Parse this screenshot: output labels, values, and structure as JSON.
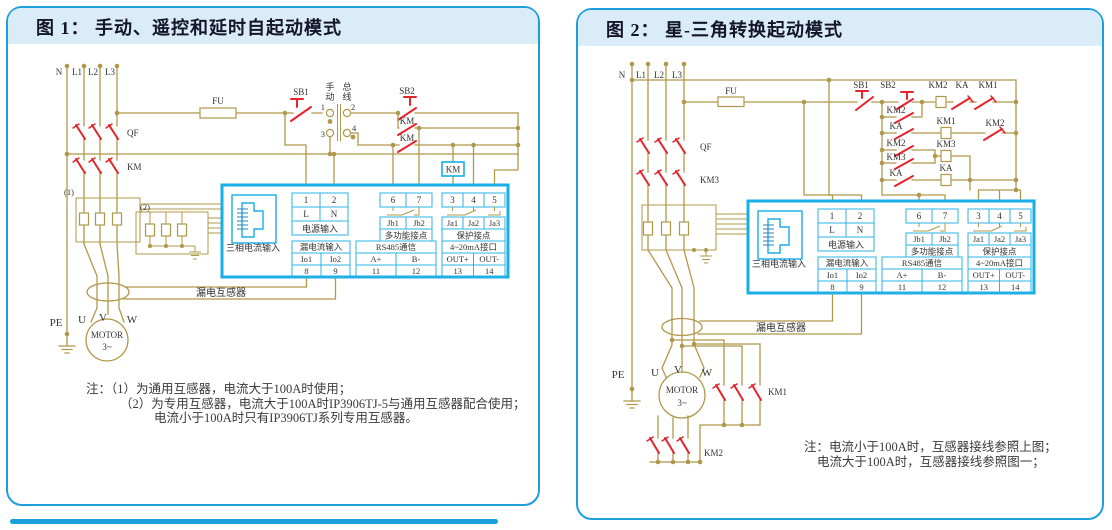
{
  "figure1": {
    "title": "图 1： 手动、遥控和延时自起动模式",
    "feeders": {
      "n": "N",
      "l1": "L1",
      "l2": "L2",
      "l3": "L3"
    },
    "labels": {
      "fu": "FU",
      "qf": "QF",
      "km_main": "KM",
      "sb1": "SB1",
      "sb2": "SB2",
      "manual_top": "手",
      "manual_bottom": "动",
      "bus_top": "总",
      "bus_bottom": "线",
      "sel1": "1",
      "sel2": "2",
      "sel3": "3",
      "sel4": "4",
      "km_aux1": "KM",
      "km_aux2": "KM",
      "km_coil": "KM",
      "ct1": "(1)",
      "ct2": "(2)",
      "pe": "PE",
      "u": "U",
      "v": "V",
      "w": "W",
      "motor": "MOTOR",
      "motor_sub": "3~",
      "leakage_ct": "漏电互感器"
    },
    "notes": [
      "注：（1）为通用互感器，电流大于100A时使用；",
      "（2）为专用互感器，电流大于100A时IP3906TJ-5与通用互感器配合使用；",
      "电流小于100A时只有IP3906TJ系列专用互感器。"
    ]
  },
  "figure2": {
    "title": "图 2： 星-三角转换起动模式",
    "feeders": {
      "n": "N",
      "l1": "L1",
      "l2": "L2",
      "l3": "L3"
    },
    "labels": {
      "fu": "FU",
      "qf": "QF",
      "km3_main": "KM3",
      "sb1": "SB1",
      "sb2": "SB2",
      "top_km2_coil": "KM2",
      "top_ka": "KA",
      "top_km1": "KM1",
      "r2_km2": "KM2",
      "r3_ka": "KA",
      "r3_km1_coil": "KM1",
      "r3_km2": "KM2",
      "r4_km2": "KM2",
      "r4_km3_coil": "KM3",
      "r5_km3": "KM3",
      "r6_ka": "KA",
      "r6_ka_coil": "KA",
      "pe": "PE",
      "u": "U",
      "v": "V",
      "w": "W",
      "motor": "MOTOR",
      "motor_sub": "3~",
      "km1_main": "KM1",
      "km2_main": "KM2",
      "leakage_ct": "漏电互感器"
    },
    "notes": [
      "注：电流小于100A时，互感器接线参照上图；",
      "电流大于100A时，互感器接线参照图一；"
    ]
  },
  "device_box": {
    "t1": "1",
    "t2": "2",
    "l": "L",
    "n": "N",
    "power_input": "电源输入",
    "t6": "6",
    "t7": "7",
    "jb1": "Jb1",
    "jb2": "Jb2",
    "multi_contact": "多功能接点",
    "t3": "3",
    "t4": "4",
    "t5": "5",
    "ja1": "Ja1",
    "ja2": "Ja2",
    "ja3": "Ja3",
    "protect_contact": "保护接点",
    "leak_input": "漏电流输入",
    "io1": "Io1",
    "io2": "Io2",
    "t8": "8",
    "t9": "9",
    "rs485": "RS485通信",
    "a_plus": "A+",
    "b_minus": "B-",
    "t11": "11",
    "t12": "12",
    "ma_port": "4~20mA接口",
    "out_plus": "OUT+",
    "out_minus": "OUT-",
    "t13": "13",
    "t14": "14",
    "three_phase_input": "三相电流输入"
  },
  "colors": {
    "panel_border": "#1b9fdd",
    "header_bg": "#d9ecf8",
    "wire": "#b0984a",
    "contact_red": "#e5232b",
    "device_border": "#18aee6",
    "text_dark": "#333333"
  }
}
